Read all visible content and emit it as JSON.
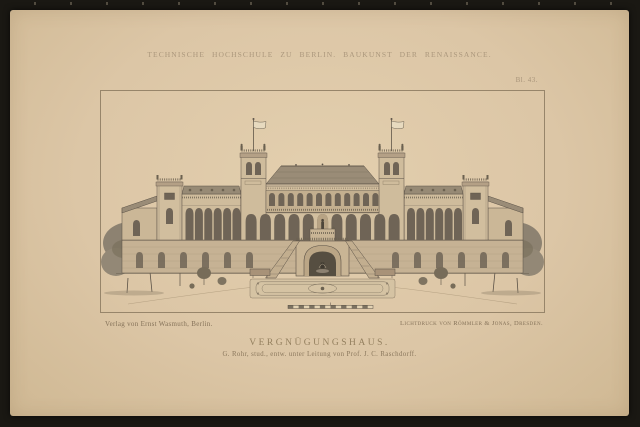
{
  "header": {
    "series_title": "TECHNISCHE HOCHSCHULE ZU BERLIN.  BAUKUNST DER RENAISSANCE.",
    "plate_number": "Bl. 43."
  },
  "plate": {
    "title": "VERGNÜGUNGSHAUS.",
    "subtitle": "G. Rohr, stud., entw. unter Leitung von Prof. J. C. Raschdorff.",
    "publisher": "Verlag von Ernst Wasmuth, Berlin.",
    "printer": "Lichtdruck von Römmler & Jonas, Dresden."
  },
  "illustration": {
    "description": "Front elevation of a Renaissance-style pleasure house: central block with arcaded loggia and twin flag towers, arcaded side wings, corner pavilions, low end extensions, terrace with central arched fountain grotto and flanking staircases, formal parterre garden and trees at both sides, with a segmented meter scale bar below."
  },
  "palette": {
    "surround": "#1a1813",
    "paper": "#dcc6a6",
    "faint_ink": "#ab977c",
    "caption_ink": "#857259",
    "drawing_dark": "#4e463a",
    "drawing_mid": "#9a8c77",
    "drawing_light": "#d2bf9f"
  }
}
